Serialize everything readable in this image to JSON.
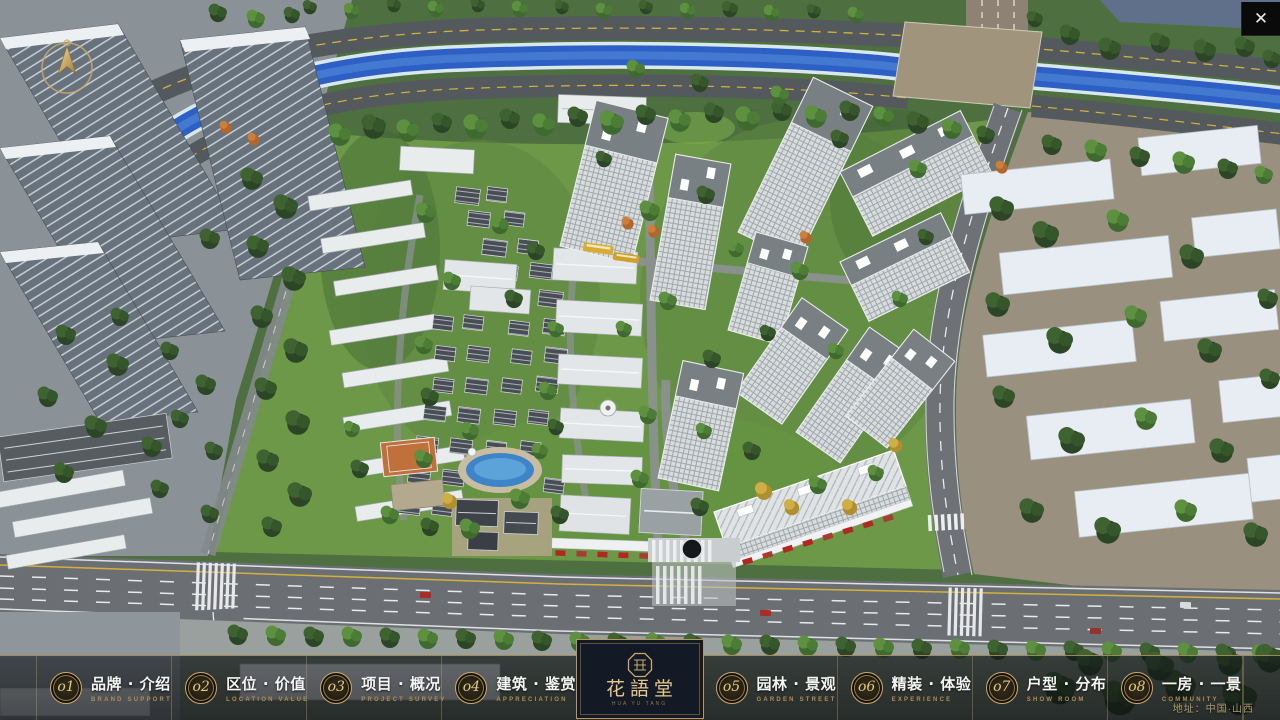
{
  "chrome": {
    "close_glyph": "✕"
  },
  "menu": {
    "items": [
      {
        "num": "o1",
        "title": "品牌 · 介绍",
        "subtitle": "BRAND SUPPORT"
      },
      {
        "num": "o2",
        "title": "区位 · 价值",
        "subtitle": "LOCATION VALUE"
      },
      {
        "num": "o3",
        "title": "项目 · 概况",
        "subtitle": "PROJECT SURVEY"
      },
      {
        "num": "o4",
        "title": "建筑 · 鉴赏",
        "subtitle": "APPRECIATION"
      },
      {
        "num": "o5",
        "title": "园林 · 景观",
        "subtitle": "GARDEN STREET"
      },
      {
        "num": "o6",
        "title": "精装 · 体验",
        "subtitle": "EXPERIENCE"
      },
      {
        "num": "o7",
        "title": "户型 · 分布",
        "subtitle": "SHOW ROOM"
      },
      {
        "num": "o8",
        "title": "一房 · 一景",
        "subtitle": "COMMUNITY"
      }
    ]
  },
  "brand": {
    "name": "花語堂",
    "tagline": "HUA YU TANG"
  },
  "footer": {
    "address": "地址：中国·山西"
  },
  "colors": {
    "gold": "#c9a96a",
    "river": "#2e5fc4"
  }
}
